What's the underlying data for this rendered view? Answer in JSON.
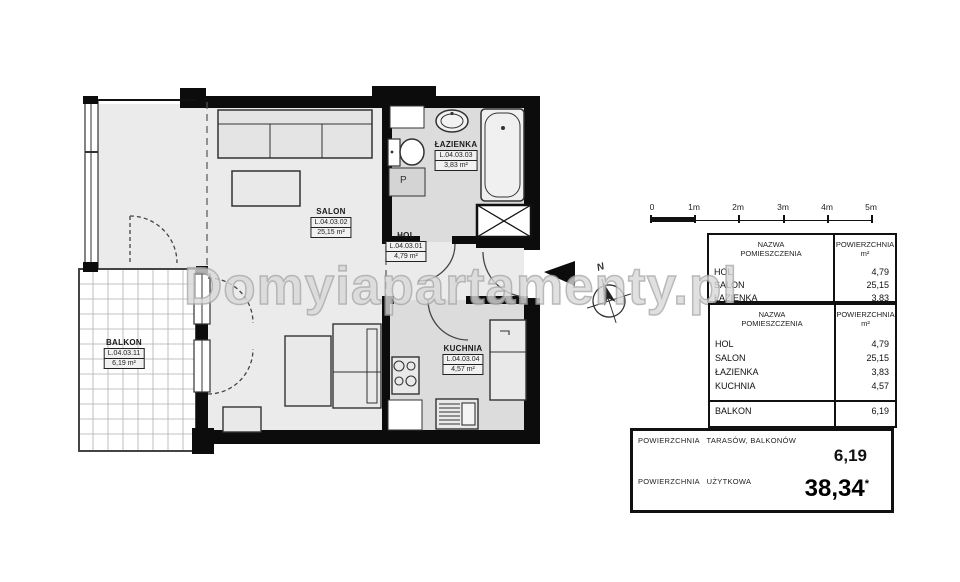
{
  "watermark": "Domyiapartamenty.pl",
  "scale_bar": {
    "labels": [
      "0",
      "1m",
      "2m",
      "3m",
      "4m",
      "5m"
    ]
  },
  "compass": {
    "north_label": "N"
  },
  "plan": {
    "rooms": [
      {
        "name": "SALON",
        "code": "L.04.03.02",
        "area": "25,15 m²"
      },
      {
        "name": "HOL",
        "code": "L.04.03.01",
        "area": "4,79 m²"
      },
      {
        "name": "ŁAZIENKA",
        "code": "L.04.03.03",
        "area": "3,83 m²"
      },
      {
        "name": "KUCHNIA",
        "code": "L.04.03.04",
        "area": "4,57 m²"
      },
      {
        "name": "BALKON",
        "code": "L.04.03.11",
        "area": "6,19 m²"
      }
    ],
    "washer_label": "P"
  },
  "table_partial": {
    "header_col1": "NAZWA\nPOMIESZCZENIA",
    "header_col2": "POWIERZCHNIA\nm²",
    "rows": [
      {
        "name": "HOL",
        "value": "4,79"
      },
      {
        "name": "SALON",
        "value": "25,15"
      },
      {
        "name": "ŁAZIENKA",
        "value": "3,83"
      }
    ]
  },
  "table_main": {
    "header_col1": "NAZWA\nPOMIESZCZENIA",
    "header_col2": "POWIERZCHNIA\nm²",
    "rows": [
      {
        "name": "HOL",
        "value": "4,79"
      },
      {
        "name": "SALON",
        "value": "25,15"
      },
      {
        "name": "ŁAZIENKA",
        "value": "3,83"
      },
      {
        "name": "KUCHNIA",
        "value": "4,57"
      }
    ],
    "balkon_row": {
      "name": "BALKON",
      "value": "6,19"
    }
  },
  "summary": {
    "balconies_label": "POWIERZCHNIA   TARASÓW, BALKONÓW",
    "balconies_value": "6,19",
    "usable_label": "POWIERZCHNIA   UŻYTKOWA",
    "usable_value": "38,34",
    "usable_note": "*"
  }
}
